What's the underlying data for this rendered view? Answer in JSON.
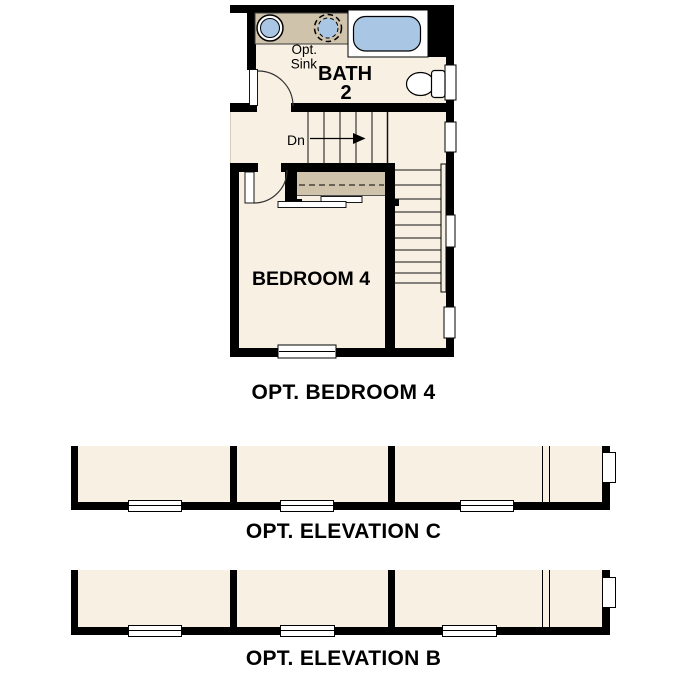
{
  "drawing": {
    "floor_plan": {
      "caption": "OPT. BEDROOM 4",
      "rooms": {
        "bath_label_line1": "BATH",
        "bath_label_line2": "2",
        "bedroom_label": "BEDROOM 4"
      },
      "annotations": {
        "opt_sink_line1": "Opt.",
        "opt_sink_line2": "Sink",
        "stair_direction": "Dn"
      },
      "fixtures": [
        "sink",
        "optional-sink",
        "bathtub",
        "toilet"
      ]
    },
    "elevation_c": {
      "caption": "OPT. ELEVATION C"
    },
    "elevation_b": {
      "caption": "OPT. ELEVATION B"
    }
  },
  "colors": {
    "background": "#ffffff",
    "wall": "#000000",
    "room_fill": "#f7f0e3",
    "counter_fill": "#cfc4ab",
    "fixture_blue": "#a9c7e4"
  }
}
